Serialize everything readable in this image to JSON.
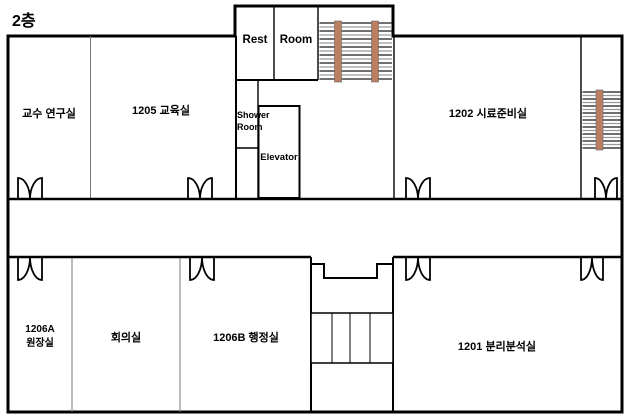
{
  "title": "2층",
  "labels": {
    "professor_office": "교수 연구실",
    "room_1205": "1205 교육실",
    "rest_left": "Rest",
    "rest_right": "Room",
    "shower_line1": "Shower",
    "shower_line2": "Room",
    "elevator": "Elevator",
    "room_1202": "1202 시료준비실",
    "room_1206a_line1": "1206A",
    "room_1206a_line2": "원장실",
    "meeting_room": "회의실",
    "room_1206b": "1206B 행정실",
    "room_1201": "1201 분리분석실"
  },
  "colors": {
    "wall": "#000000",
    "room_divider": "#777777",
    "stair_rail": "#bb7e61",
    "stair_tread_shadow": "#9a9a9a"
  }
}
